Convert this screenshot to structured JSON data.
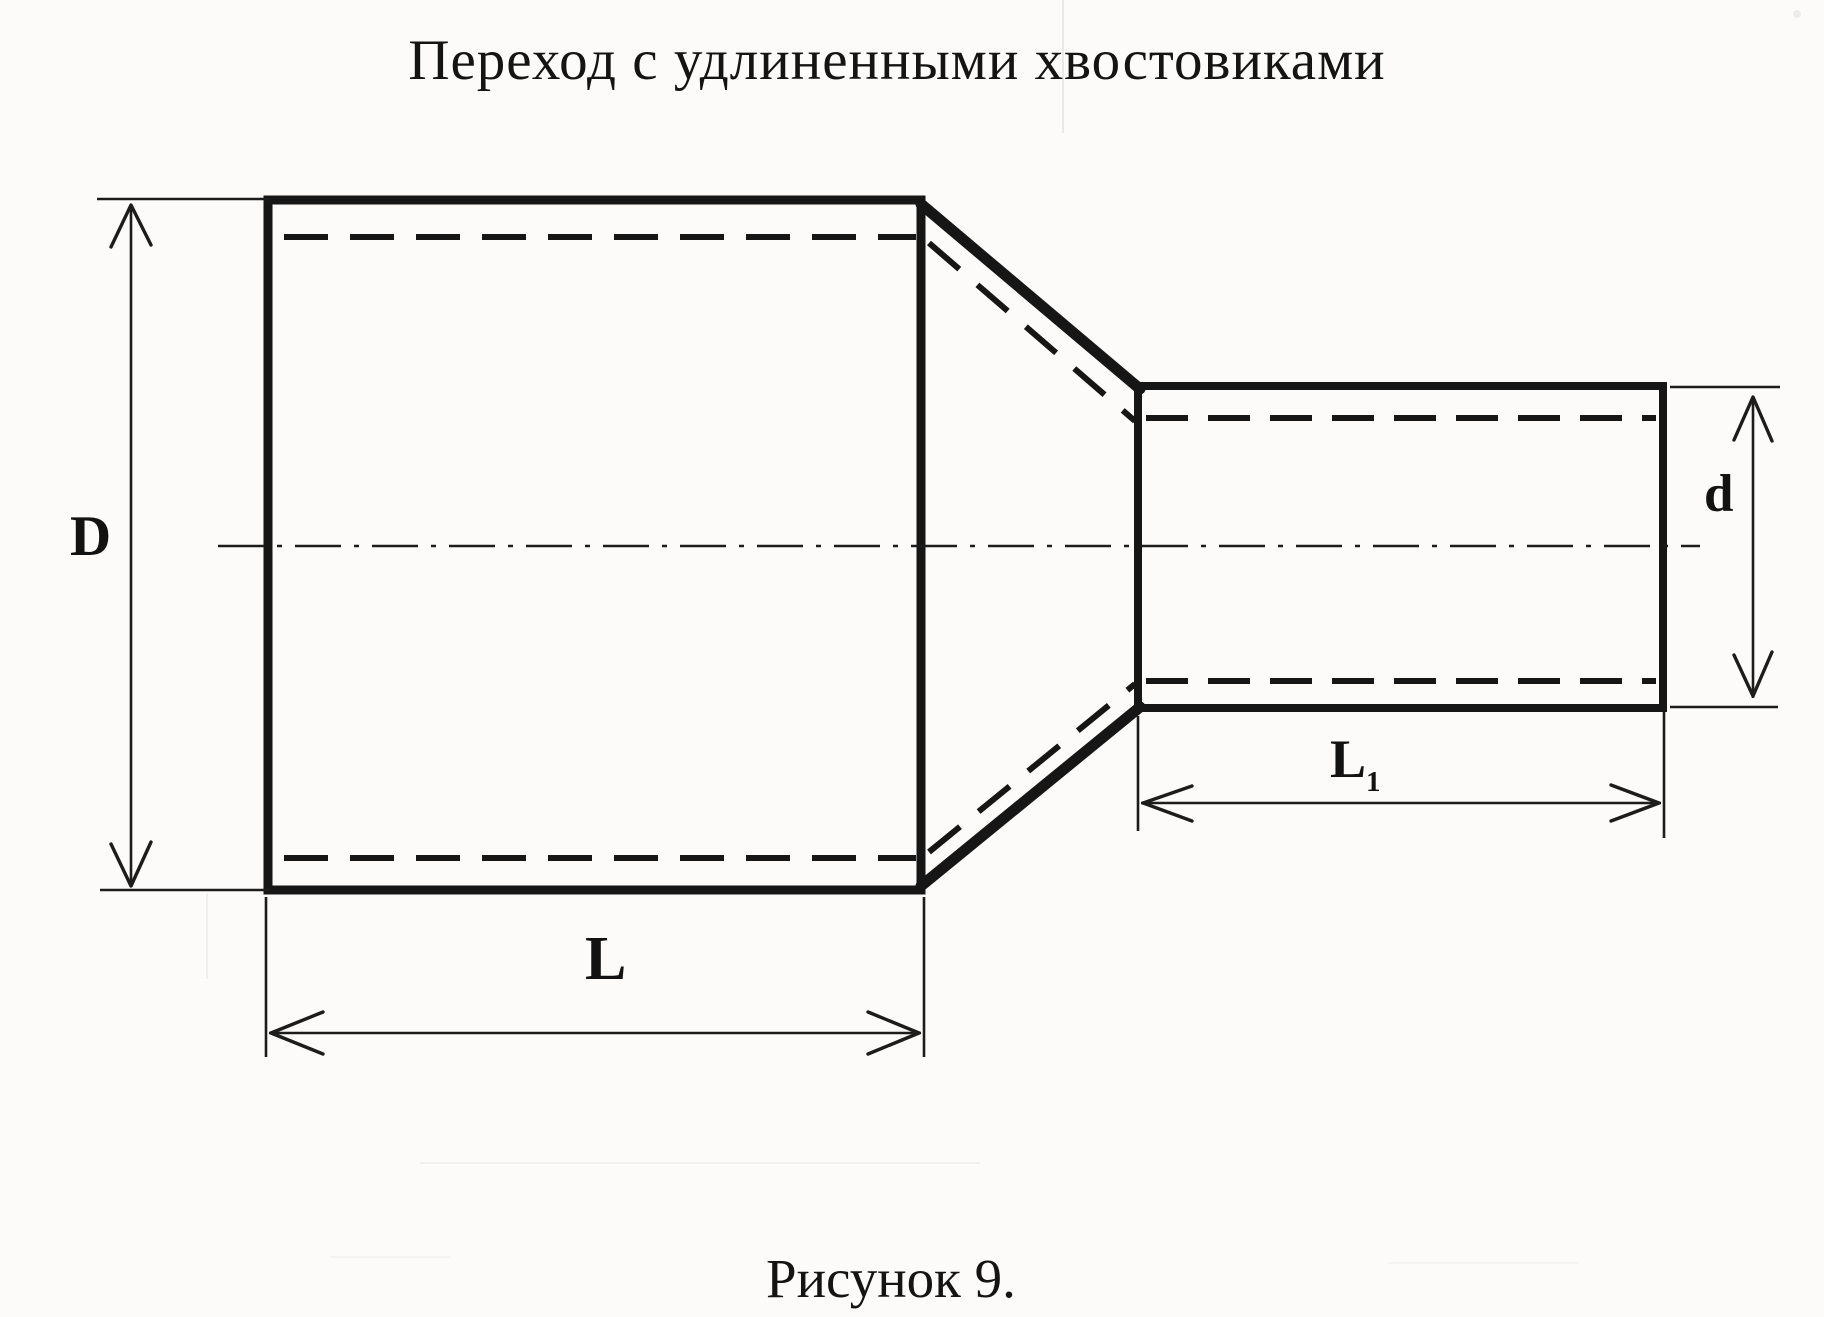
{
  "title": "Переход с удлиненными хвостовиками",
  "caption": "Рисунок 9.",
  "labels": {
    "large_diameter": "D",
    "large_length": "L",
    "small_diameter": "d",
    "small_length_base": "L",
    "small_length_sub": "1"
  },
  "colors": {
    "ink": "#161616",
    "paper": "#fcfbf9"
  }
}
